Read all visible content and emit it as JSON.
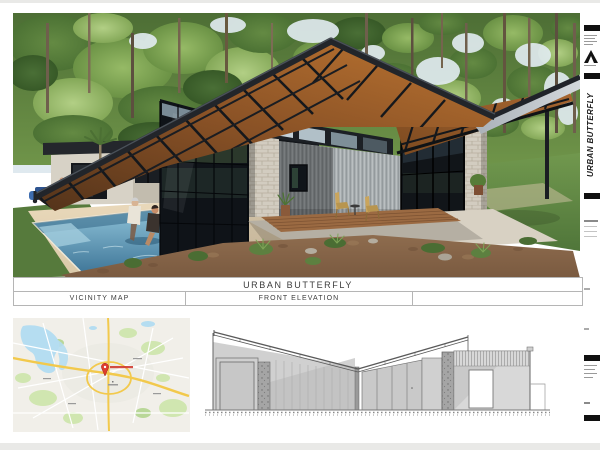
{
  "sheet": {
    "title_band": "URBAN BUTTERFLY",
    "label_cells": [
      {
        "label": "VICINITY MAP"
      },
      {
        "label": "FRONT ELEVATION"
      },
      {
        "label": ""
      }
    ]
  },
  "titleblock": {
    "vertical_title": "URBAN BUTTERFLY"
  },
  "render": {
    "subject": "modern-butterfly-roof-house-exterior-render",
    "colors": {
      "roof_dark": "#23262b",
      "soffit_wood": "#9a5e2a",
      "forest_green": "#5d8040",
      "pool_water": "#4f86a8",
      "stone": "#d2ccc0",
      "metal_siding": "#aab0b2",
      "grass": "#5f8240",
      "mulch": "#8c6a4c"
    }
  },
  "vicinity_map": {
    "marker": "red-location-pin",
    "colors": {
      "land": "#f1efe9",
      "water": "#b5ddf1",
      "park": "#cfe6ad",
      "road_major": "#f2c94c",
      "road_minor": "#ffffff",
      "marker_red": "#de3c2e"
    }
  },
  "elevation": {
    "drawing": "front-elevation-butterfly-roof",
    "line_color": "#6a6a6a"
  }
}
